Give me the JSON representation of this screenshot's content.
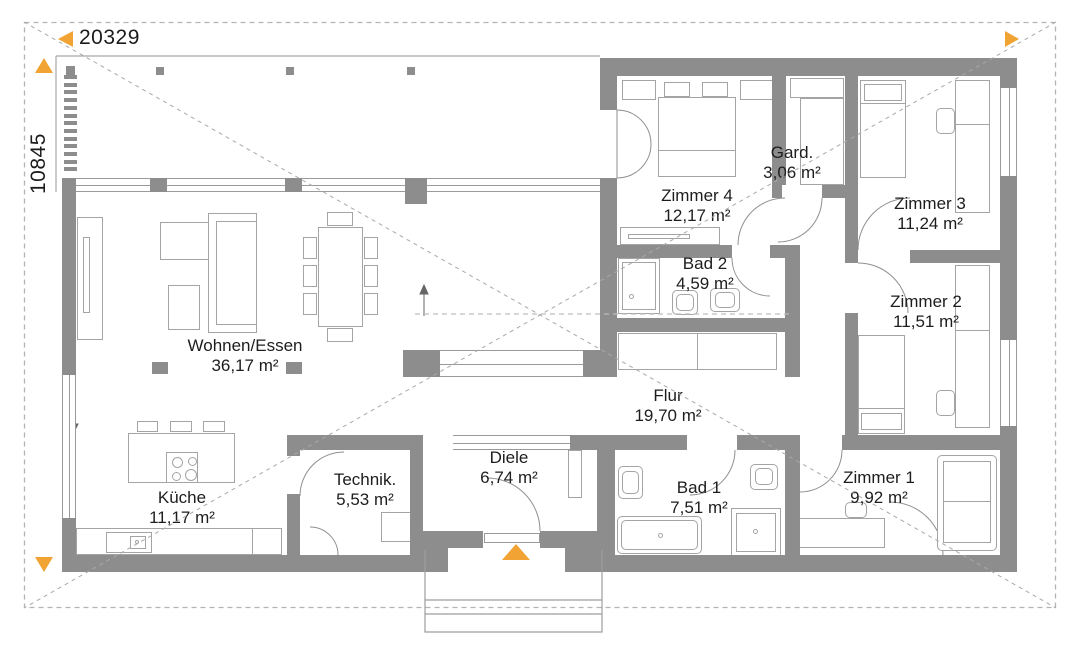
{
  "drawing": {
    "width_dim": "20329",
    "height_dim": "10845"
  },
  "rooms": [
    {
      "id": "wohnen-essen",
      "name": "Wohnen/Essen",
      "area": "36,17 m²"
    },
    {
      "id": "kueche",
      "name": "Küche",
      "area": "11,17 m²"
    },
    {
      "id": "technik",
      "name": "Technik.",
      "area": "5,53 m²"
    },
    {
      "id": "diele",
      "name": "Diele",
      "area": "6,74 m²"
    },
    {
      "id": "flur",
      "name": "Flur",
      "area": "19,70 m²"
    },
    {
      "id": "bad1",
      "name": "Bad 1",
      "area": "7,51 m²"
    },
    {
      "id": "zimmer1",
      "name": "Zimmer 1",
      "area": "9,92 m²"
    },
    {
      "id": "zimmer2",
      "name": "Zimmer 2",
      "area": "11,51 m²"
    },
    {
      "id": "zimmer3",
      "name": "Zimmer 3",
      "area": "11,24 m²"
    },
    {
      "id": "zimmer4",
      "name": "Zimmer 4",
      "area": "12,17 m²"
    },
    {
      "id": "gard",
      "name": "Gard.",
      "area": "3,06 m²"
    },
    {
      "id": "bad2",
      "name": "Bad 2",
      "area": "4,59 m²"
    }
  ],
  "colors": {
    "accent": "#F1A433",
    "wall": "#8D8D8D"
  }
}
